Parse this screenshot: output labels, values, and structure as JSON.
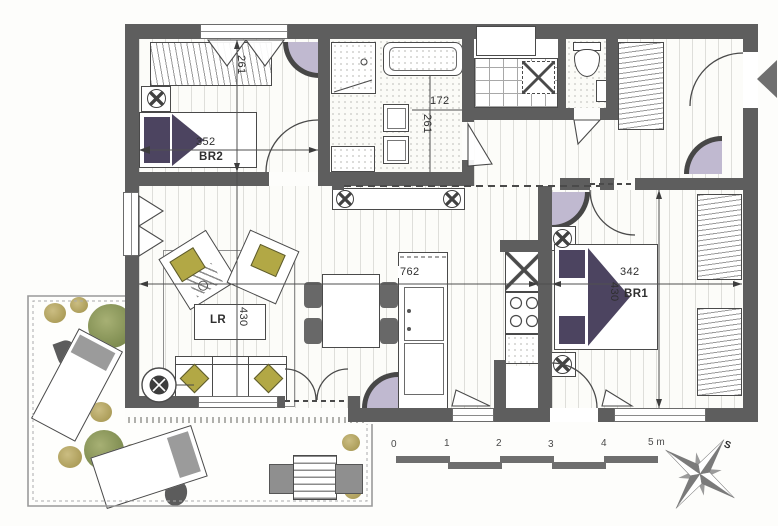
{
  "rooms": {
    "br2": {
      "label": "BR2",
      "width_cm": "352",
      "depth_cm": "261"
    },
    "bathroom": {
      "width_cm": "172",
      "depth_cm": "261"
    },
    "living_room": {
      "label": "LR",
      "depth_cm": "430",
      "combined_width_cm": "762"
    },
    "br1": {
      "label": "BR1",
      "width_cm": "342",
      "depth_cm": "430"
    }
  },
  "scale_bar": {
    "unit_labels": [
      "0",
      "1",
      "2",
      "3",
      "4",
      "5 m"
    ]
  },
  "compass": {
    "north_label": "S"
  },
  "colors": {
    "wall": "#5e5e5e",
    "accent_olive": "#b2a845",
    "accent_purple": "#4c4460",
    "plant_green": "#8d9a58",
    "corner_lavender": "#c0b9d0"
  }
}
